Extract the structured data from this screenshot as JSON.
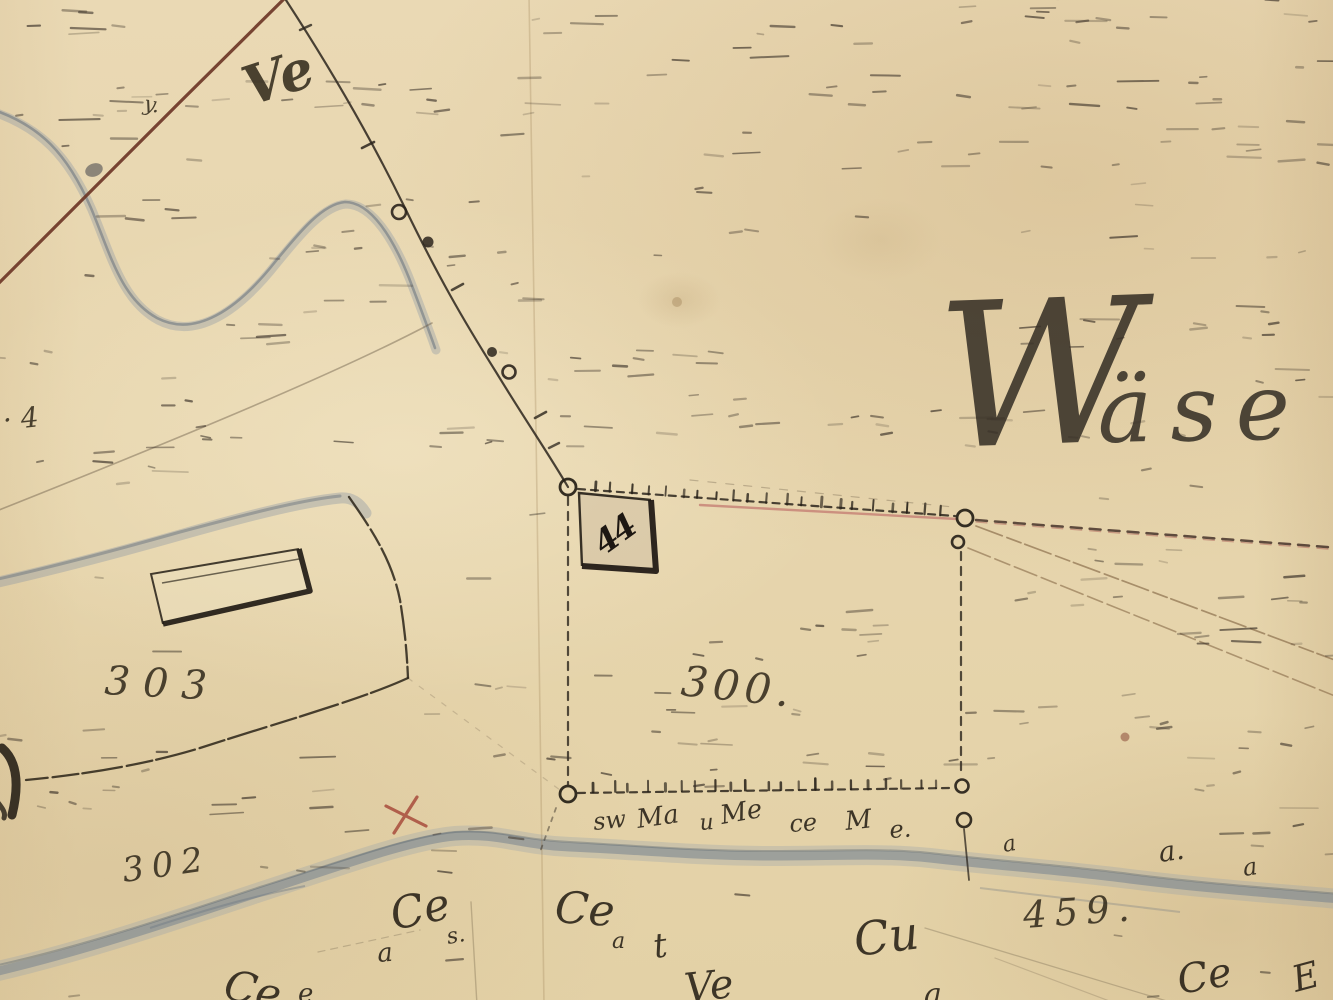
{
  "map": {
    "description": "Aged hand-drawn cadastral survey map sheet",
    "palette": {
      "paper": "#e7d6b0",
      "ink": "#2b241c",
      "red_survey_line": "#6a3324",
      "pink_boundary": "#c0746c",
      "sepia_construction": "#7d5f3e",
      "water": "#7d8997",
      "water_dark": "#5e6a78",
      "red_cross": "#a84c3c"
    },
    "labels": {
      "script_place_name": {
        "text": "Wäse"
      },
      "parcel_300": {
        "text": "300."
      },
      "parcel_303": {
        "text": "303"
      },
      "parcel_302": {
        "text": "302"
      },
      "parcel_459": {
        "text": "459."
      },
      "house_number": {
        "text": "44"
      },
      "edge_number": {
        "text": "· 4"
      },
      "small_mark": {
        "text": "y."
      },
      "flourish": {
        "text": "Ve"
      }
    },
    "parcels": [
      {
        "number": "300"
      },
      {
        "number": "302"
      },
      {
        "number": "303"
      },
      {
        "number": "459"
      }
    ],
    "house_numbers": [
      "44"
    ],
    "decorations": {
      "bank_scribbles": [
        {
          "t": "sw",
          "x": 594,
          "y": 830,
          "s": 24,
          "r": -6
        },
        {
          "t": "Ma",
          "x": 638,
          "y": 828,
          "s": 26,
          "r": -8
        },
        {
          "t": "u",
          "x": 700,
          "y": 830,
          "s": 22,
          "r": -4
        },
        {
          "t": "Me",
          "x": 722,
          "y": 824,
          "s": 26,
          "r": -10
        },
        {
          "t": "ce",
          "x": 790,
          "y": 832,
          "s": 24,
          "r": -4
        },
        {
          "t": "M",
          "x": 846,
          "y": 830,
          "s": 26,
          "r": -6
        },
        {
          "t": "e.",
          "x": 890,
          "y": 838,
          "s": 24,
          "r": -4
        },
        {
          "t": "a",
          "x": 1004,
          "y": 852,
          "s": 22,
          "r": -10
        },
        {
          "t": "a.",
          "x": 1160,
          "y": 862,
          "s": 28,
          "r": -8
        },
        {
          "t": "a",
          "x": 1244,
          "y": 876,
          "s": 24,
          "r": -8
        }
      ],
      "scribbles": [
        {
          "t": "Ce",
          "x": 394,
          "y": 930,
          "s": 44,
          "r": -12
        },
        {
          "t": "a",
          "x": 378,
          "y": 962,
          "s": 26,
          "r": -5
        },
        {
          "t": "s.",
          "x": 448,
          "y": 944,
          "s": 22,
          "r": -10
        },
        {
          "t": "Ce",
          "x": 554,
          "y": 922,
          "s": 44,
          "r": 4
        },
        {
          "t": "a",
          "x": 612,
          "y": 948,
          "s": 22,
          "r": 0
        },
        {
          "t": "t",
          "x": 655,
          "y": 958,
          "s": 34,
          "r": -8
        },
        {
          "t": "Cu",
          "x": 856,
          "y": 956,
          "s": 46,
          "r": -7
        },
        {
          "t": "Ce",
          "x": 1180,
          "y": 994,
          "s": 40,
          "r": -10
        },
        {
          "t": "Ce",
          "x": 222,
          "y": 998,
          "s": 42,
          "r": 12
        },
        {
          "t": "e",
          "x": 298,
          "y": 1002,
          "s": 26,
          "r": 0
        },
        {
          "t": "Ve",
          "x": 686,
          "y": 1002,
          "s": 40,
          "r": -6
        },
        {
          "t": "a",
          "x": 924,
          "y": 1004,
          "s": 30,
          "r": 0
        },
        {
          "t": "E",
          "x": 1296,
          "y": 992,
          "s": 36,
          "r": -15
        }
      ]
    }
  }
}
